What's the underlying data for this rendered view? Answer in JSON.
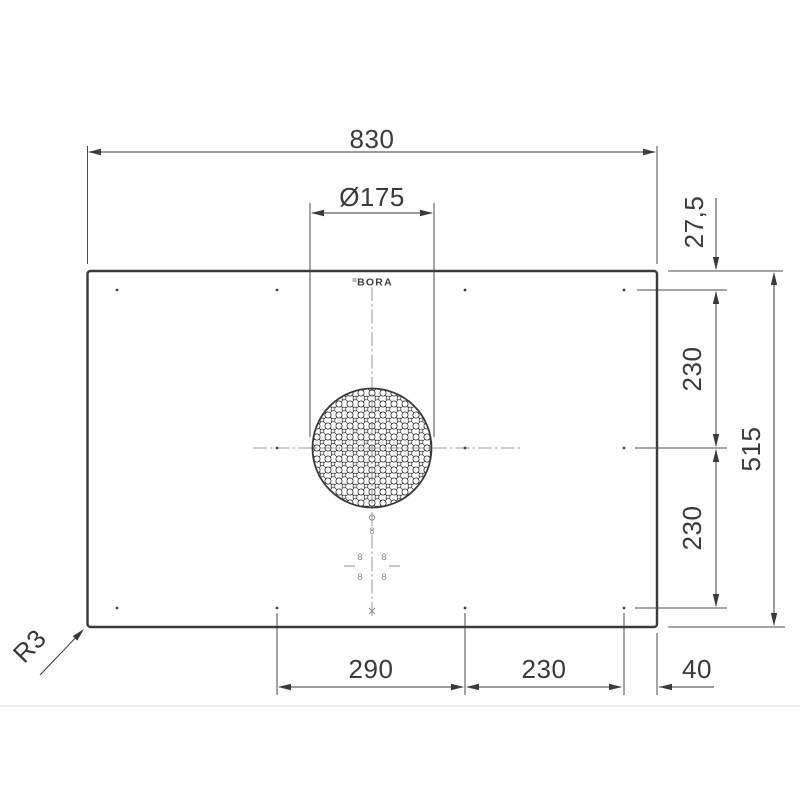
{
  "drawing": {
    "brand_logo": "BORA",
    "dims": {
      "total_width": "830",
      "intake_diameter": "Ø175",
      "top_edge_offset": "27,5",
      "right_upper_span": "230",
      "right_lower_span": "230",
      "total_depth": "515",
      "bottom_left_span": "290",
      "bottom_mid_span": "230",
      "bottom_right_offset": "40",
      "corner_radius": "R3"
    },
    "control_display_digits": [
      "8",
      "8",
      "8",
      "8",
      "8"
    ],
    "colors": {
      "line": "#3a3a3a",
      "faint_marks": "#909090",
      "divider": "#e4e4e4",
      "background": "#ffffff"
    }
  }
}
